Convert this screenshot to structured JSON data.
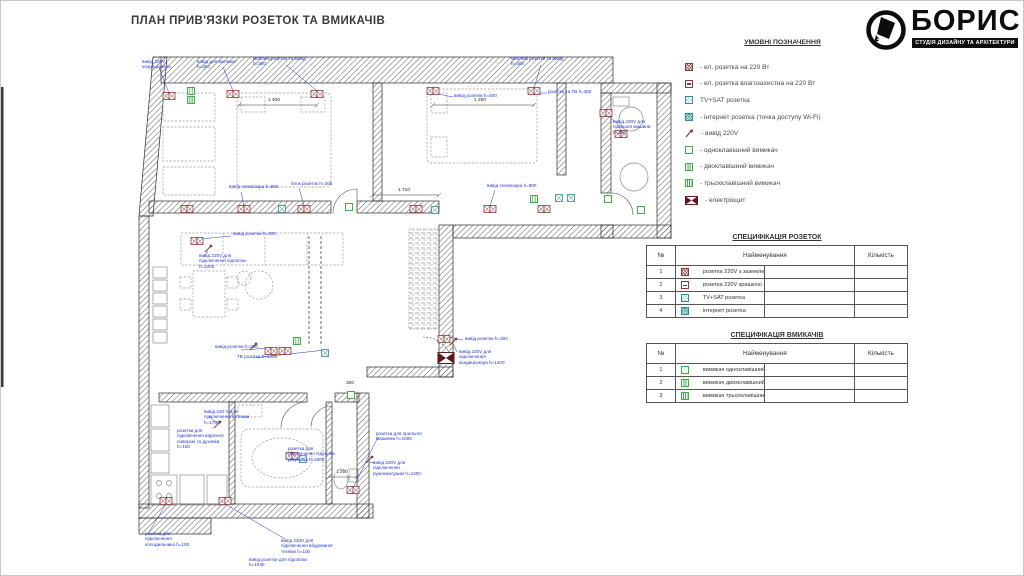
{
  "title": "ПЛАН ПРИВ'ЯЗКИ РОЗЕТОК ТА ВМИКАЧІВ",
  "logo": {
    "name": "БОРИС",
    "subtitle": "СТУДІЯ ДИЗАЙНУ ТА АРХІТЕКТУРИ"
  },
  "colors": {
    "socket": "#8a3a3a",
    "tv_internet": "#2e8f8f",
    "switch": "#3fae49",
    "panel": "#5d1a1a",
    "annotation": "#2334cc"
  },
  "legend": {
    "heading": "УМОВНІ ПОЗНАЧЕННЯ",
    "items": [
      {
        "icon": "socket-220-icon",
        "label": "- ел. розетка на 220 Вт"
      },
      {
        "icon": "socket-waterproof-icon",
        "label": "- ел. розетка влагозахистна на 220 Вт"
      },
      {
        "icon": "tv-sat-icon",
        "label": "TV+SAT розетка"
      },
      {
        "icon": "internet-icon",
        "label": "- інтернет розетка (точка доступу Wi-Fi)"
      },
      {
        "icon": "outlet-220v-lead-icon",
        "label": "- вивід 220V"
      },
      {
        "icon": "switch-single-icon",
        "label": "- одноклавішний вимикач"
      },
      {
        "icon": "switch-double-icon",
        "label": "- двоклавішний вимикач"
      },
      {
        "icon": "switch-triple-icon",
        "label": "- трьохклавішний вимикач"
      },
      {
        "icon": "electrical-panel-icon",
        "label": "- електрощит"
      }
    ]
  },
  "tables": {
    "sockets": {
      "title": "СПЕЦИФІКАЦІЯ РОЗЕТОК",
      "columns": {
        "no": "№",
        "name": "Найменування",
        "qty": "Кількість"
      },
      "rows": [
        {
          "no": "1",
          "icon": "socket-220-icon",
          "name": "розетка 220V з заземленням",
          "qty": ""
        },
        {
          "no": "2",
          "icon": "socket-waterproof-icon",
          "name": "розетка 220V кришкою IP44",
          "qty": ""
        },
        {
          "no": "3",
          "icon": "tv-sat-icon",
          "name": "TV+SAT розетка",
          "qty": ""
        },
        {
          "no": "4",
          "icon": "internet-icon",
          "name": "інтернет розетка",
          "qty": ""
        }
      ]
    },
    "switches": {
      "title": "СПЕЦИФІКАЦІЯ ВМИКАЧІВ",
      "columns": {
        "no": "№",
        "name": "Найменування",
        "qty": "Кількість"
      },
      "rows": [
        {
          "no": "1",
          "icon": "switch-single-icon",
          "name": "вимикач одноклавішний",
          "qty": ""
        },
        {
          "no": "2",
          "icon": "switch-double-icon",
          "name": "вимикач двохклавішний",
          "qty": ""
        },
        {
          "no": "3",
          "icon": "switch-triple-icon",
          "name": "вимикач трьохклавішний",
          "qty": ""
        }
      ]
    }
  },
  "plan": {
    "annotations": [
      {
        "t": "вивід 220V кондиціонера"
      },
      {
        "t": "вивід для витяжки h=300"
      },
      {
        "t": "меблеві розетки та вивід h=300"
      },
      {
        "t": "меблеві розетки та вивід h=300"
      },
      {
        "t": "вивід розетки h=400"
      },
      {
        "t": "розетка та ТВ h=300"
      },
      {
        "t": "вивід 220V для пральної машини h=200"
      },
      {
        "t": "вивід телевізора h=900"
      },
      {
        "t": "блок розеток h=300"
      },
      {
        "t": "вивід телевізора h=900"
      },
      {
        "t": "вивід 220V для підключення підсвітки h=2200"
      },
      {
        "t": "вивід розетки h=300"
      },
      {
        "t": "вивід розетки h=300"
      },
      {
        "t": "ТВ розетка h=1400"
      },
      {
        "t": "вивід розетки h=300"
      },
      {
        "t": "вивід 220V для підключення кондиціонера h=1400"
      },
      {
        "t": "розетки для підключення варочної поверхні та духовки h=100"
      },
      {
        "t": "вивід 220 V для підключення витяжки h=1700"
      },
      {
        "t": "розетка для підключення підсвітки дзеркала h=2000"
      },
      {
        "t": "розетка для пральної машинки h=1000"
      },
      {
        "t": "вивід 220V для підключення рушникосушки h=1200"
      },
      {
        "t": "розетка для підключення холодильника h=100"
      },
      {
        "t": "вивід 220V для підключення вбудованої техніки h=100"
      },
      {
        "t": "вивід розетки для підсвітки h=1040"
      }
    ],
    "dims": [
      {
        "t": "1 400"
      },
      {
        "t": "1 250"
      },
      {
        "t": "1 710"
      },
      {
        "t": "1 200"
      },
      {
        "t": "300"
      }
    ]
  }
}
